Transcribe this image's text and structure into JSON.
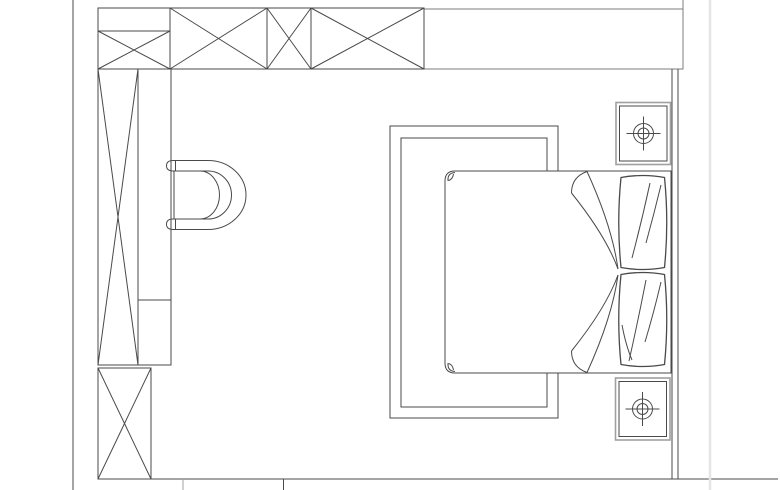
{
  "canvas": {
    "width": 780,
    "height": 490,
    "background": "#ffffff"
  },
  "palette": {
    "dark": "#4a4a4a",
    "mid": "#7d7d7d",
    "light": "#a0a0a0",
    "faint": "#e4e4e4",
    "fill": "#ffffff"
  },
  "floor_plan": {
    "group_order": [
      "walls",
      "wardrobe_top",
      "wardrobe_left",
      "armchair",
      "rug",
      "bed",
      "pillows",
      "nightstand_top",
      "nightstand_bottom"
    ],
    "groups": {
      "walls": [
        {
          "name": "left-wall-line",
          "type": "line",
          "x1": 73,
          "y1": 0,
          "x2": 73,
          "y2": 490
        },
        {
          "name": "top-wall-right-strip",
          "type": "rect",
          "x": 424,
          "y": 9,
          "w": 259,
          "h": 60,
          "stroke": "mid"
        },
        {
          "name": "top-wall-right-corner-line",
          "type": "line",
          "x1": 683,
          "y1": 0,
          "x2": 683,
          "y2": 9,
          "stroke": "mid"
        },
        {
          "name": "right-wall-inner-line",
          "type": "line",
          "x1": 672,
          "y1": 69,
          "x2": 672,
          "y2": 479
        },
        {
          "name": "right-wall-outer-line",
          "type": "line",
          "x1": 678,
          "y1": 69,
          "x2": 678,
          "y2": 479
        },
        {
          "name": "bottom-wall-line",
          "type": "line",
          "x1": 98,
          "y1": 479,
          "x2": 778,
          "y2": 479
        },
        {
          "name": "bottom-wall-tick-left",
          "type": "line",
          "x1": 183,
          "y1": 479,
          "x2": 183,
          "y2": 490,
          "stroke": "light"
        },
        {
          "name": "bottom-wall-tick-right",
          "type": "line",
          "x1": 283.5,
          "y1": 479,
          "x2": 283.5,
          "y2": 490
        },
        {
          "name": "page-edge-line",
          "type": "line",
          "x1": 710,
          "y1": 0,
          "x2": 710,
          "y2": 490,
          "stroke": "faint",
          "sw": 2.5
        }
      ],
      "wardrobe_top": [
        {
          "name": "wardrobe-top-cabinet-a",
          "type": "rect",
          "x": 98,
          "y": 8,
          "w": 72,
          "h": 61
        },
        {
          "name": "cabinet-a-shelf-line",
          "type": "line",
          "x1": 98,
          "y1": 31,
          "x2": 170,
          "y2": 31
        },
        {
          "name": "cabinet-a-cross-line-1",
          "type": "line",
          "x1": 98,
          "y1": 31,
          "x2": 170,
          "y2": 69
        },
        {
          "name": "cabinet-a-cross-line-2",
          "type": "line",
          "x1": 170,
          "y1": 31,
          "x2": 98,
          "y2": 69
        },
        {
          "name": "wardrobe-top-cabinet-b",
          "type": "rect",
          "x": 170,
          "y": 8,
          "w": 97,
          "h": 61
        },
        {
          "name": "cabinet-b-cross-line-1",
          "type": "line",
          "x1": 170,
          "y1": 8,
          "x2": 267,
          "y2": 69
        },
        {
          "name": "cabinet-b-cross-line-2",
          "type": "line",
          "x1": 267,
          "y1": 8,
          "x2": 170,
          "y2": 69
        },
        {
          "name": "wardrobe-top-cabinet-c",
          "type": "rect",
          "x": 267,
          "y": 8,
          "w": 44,
          "h": 61
        },
        {
          "name": "cabinet-c-cross-line-1",
          "type": "line",
          "x1": 267,
          "y1": 8,
          "x2": 311,
          "y2": 69
        },
        {
          "name": "cabinet-c-cross-line-2",
          "type": "line",
          "x1": 311,
          "y1": 8,
          "x2": 267,
          "y2": 69
        },
        {
          "name": "wardrobe-top-cabinet-d",
          "type": "rect",
          "x": 311,
          "y": 8,
          "w": 113,
          "h": 61
        },
        {
          "name": "cabinet-d-cross-line-1",
          "type": "line",
          "x1": 311,
          "y1": 8,
          "x2": 424,
          "y2": 69
        },
        {
          "name": "cabinet-d-cross-line-2",
          "type": "line",
          "x1": 424,
          "y1": 8,
          "x2": 311,
          "y2": 69
        }
      ],
      "wardrobe_left": [
        {
          "name": "wardrobe-left-tall-cabinet",
          "type": "rect",
          "x": 98,
          "y": 69,
          "w": 40,
          "h": 296
        },
        {
          "name": "tall-cabinet-cross-line-1",
          "type": "line",
          "x1": 98,
          "y1": 69,
          "x2": 138,
          "y2": 365
        },
        {
          "name": "tall-cabinet-cross-line-2",
          "type": "line",
          "x1": 138,
          "y1": 69,
          "x2": 98,
          "y2": 365
        },
        {
          "name": "wardrobe-left-side-column",
          "type": "rect",
          "x": 138,
          "y": 69,
          "w": 33,
          "h": 296
        },
        {
          "name": "side-column-shelf-line",
          "type": "line",
          "x1": 138,
          "y1": 300,
          "x2": 171,
          "y2": 300
        },
        {
          "name": "wardrobe-left-lower-cabinet",
          "type": "rect",
          "x": 98,
          "y": 368,
          "w": 53,
          "h": 111
        },
        {
          "name": "lower-cabinet-cross-line-1",
          "type": "line",
          "x1": 98,
          "y1": 368,
          "x2": 151,
          "y2": 479
        },
        {
          "name": "lower-cabinet-cross-line-2",
          "type": "line",
          "x1": 151,
          "y1": 368,
          "x2": 98,
          "y2": 479
        }
      ],
      "armchair": [
        {
          "name": "armchair-top-armrest",
          "type": "path",
          "d": "M 208 160.5 L 173 160.5 Q 166.5 160.5 166.5 165.8 Q 166.5 171 173 171 L 208 171"
        },
        {
          "name": "armchair-top-armrest-cap-line",
          "type": "line",
          "x1": 175.5,
          "y1": 160.5,
          "x2": 175.5,
          "y2": 171
        },
        {
          "name": "armchair-bottom-armrest",
          "type": "path",
          "d": "M 208 219 L 173 219 Q 166.5 219 166.5 224.3 Q 166.5 229.5 173 229.5 L 208 229.5"
        },
        {
          "name": "armchair-bottom-armrest-cap-line",
          "type": "line",
          "x1": 175.5,
          "y1": 219,
          "x2": 175.5,
          "y2": 229.5
        },
        {
          "name": "armchair-backrest-outer-arc",
          "type": "path",
          "d": "M 208 160.5 A 38 34.5 0 0 1 208 229.5"
        },
        {
          "name": "armchair-backrest-inner-arc",
          "type": "path",
          "d": "M 208 171 A 23.5 24 0 0 1 208 219"
        },
        {
          "name": "armchair-seatback-arc",
          "type": "path",
          "d": "M 200 171 A 19.5 24 0 0 1 200 219"
        },
        {
          "name": "armchair-seat-front-line",
          "type": "line",
          "x1": 174,
          "y1": 171,
          "x2": 174,
          "y2": 219
        }
      ],
      "rug": [
        {
          "name": "rug-outer-border",
          "type": "rect",
          "x": 390,
          "y": 126,
          "w": 168,
          "h": 292
        },
        {
          "name": "rug-inner-border",
          "type": "rect",
          "x": 401,
          "y": 138,
          "w": 146,
          "h": 269
        }
      ],
      "bed": [
        {
          "name": "bed-outline",
          "type": "path",
          "d": "M 671 171 L 455 171 Q 445 171 445 181 L 445 363 Q 445 373 455 373 L 671 373 Z",
          "fill": "white"
        },
        {
          "name": "bed-corner-curl-top",
          "type": "path",
          "d": "M 455 172.5 Q 447.5 173 448 180.5 Q 452.5 180 453.5 174"
        },
        {
          "name": "bed-corner-curl-bottom",
          "type": "path",
          "d": "M 455 371.5 Q 447.5 371 448 363.5 Q 452.5 364 453.5 370"
        },
        {
          "name": "duvet-fold-top-curl",
          "type": "path",
          "d": "M 587 171.5 Q 571.5 177 571.5 193"
        },
        {
          "name": "duvet-fold-top-sweep-1",
          "type": "path",
          "d": "M 571.5 193 Q 606 236 618 269"
        },
        {
          "name": "duvet-fold-top-sweep-2",
          "type": "path",
          "d": "M 587 171.5 Q 612 226 618 269"
        },
        {
          "name": "duvet-fold-bottom-curl",
          "type": "path",
          "d": "M 587 372.5 Q 571.5 367 571.5 351"
        },
        {
          "name": "duvet-fold-bottom-sweep-1",
          "type": "path",
          "d": "M 571.5 351 Q 606 308 618 275"
        },
        {
          "name": "duvet-fold-bottom-sweep-2",
          "type": "path",
          "d": "M 587 372.5 Q 612 318 618 275"
        }
      ],
      "pillows": [
        {
          "name": "pillow-top",
          "type": "path",
          "d": "M 621 177.5 Q 643 173.5 664.5 177.5 Q 669 222.5 664.5 267.5 Q 643 271.5 621 267.5 Q 616.5 222.5 621 177.5 Z",
          "fill": "white",
          "sw": 1.3
        },
        {
          "name": "pillow-top-fold-line-1",
          "type": "path",
          "d": "M 650 183 Q 642 220 632 258"
        },
        {
          "name": "pillow-top-fold-line-2",
          "type": "path",
          "d": "M 661 185 Q 654 214 646 243"
        },
        {
          "name": "pillow-bottom",
          "type": "path",
          "d": "M 621 274.5 Q 643 270.5 664.5 274.5 Q 669 319.5 664.5 364.5 Q 643 368.5 621 364.5 Q 616.5 319.5 621 274.5 Z",
          "fill": "white",
          "sw": 1.3
        },
        {
          "name": "pillow-bottom-fold-line-1",
          "type": "path",
          "d": "M 646 280 Q 638 321 629 361"
        },
        {
          "name": "pillow-bottom-fold-line-2",
          "type": "path",
          "d": "M 661 282 Q 654 312 645 342"
        },
        {
          "name": "pillow-bottom-fold-line-3",
          "type": "path",
          "d": "M 622 325 Q 626 346 632 360"
        }
      ],
      "nightstand_top": [
        {
          "name": "nightstand-top-outer",
          "type": "rect",
          "x": 616,
          "y": 102.5,
          "w": 54.5,
          "h": 62,
          "stroke": "light",
          "sw": 1.6,
          "fill": "white"
        },
        {
          "name": "nightstand-top-inner",
          "type": "rect",
          "x": 619.5,
          "y": 106,
          "w": 47.5,
          "h": 55
        },
        {
          "name": "lamp-top-outer-circle",
          "type": "circle",
          "cx": 643.5,
          "cy": 133.5,
          "r": 10
        },
        {
          "name": "lamp-top-inner-circle",
          "type": "circle",
          "cx": 643.5,
          "cy": 133.5,
          "r": 5.5
        },
        {
          "name": "lamp-top-crosshair-h",
          "type": "line",
          "x1": 626.5,
          "y1": 133.5,
          "x2": 660.5,
          "y2": 133.5
        },
        {
          "name": "lamp-top-crosshair-v",
          "type": "line",
          "x1": 643.5,
          "y1": 116.5,
          "x2": 643.5,
          "y2": 150.5
        }
      ],
      "nightstand_bottom": [
        {
          "name": "nightstand-bottom-outer",
          "type": "rect",
          "x": 615.5,
          "y": 378,
          "w": 54.5,
          "h": 62,
          "stroke": "light",
          "sw": 1.6,
          "fill": "white"
        },
        {
          "name": "nightstand-bottom-inner",
          "type": "rect",
          "x": 619,
          "y": 381.5,
          "w": 47.5,
          "h": 55
        },
        {
          "name": "lamp-bottom-outer-circle",
          "type": "circle",
          "cx": 642.5,
          "cy": 409,
          "r": 10
        },
        {
          "name": "lamp-bottom-inner-circle",
          "type": "circle",
          "cx": 642.5,
          "cy": 409,
          "r": 5.5
        },
        {
          "name": "lamp-bottom-crosshair-h",
          "type": "line",
          "x1": 625.5,
          "y1": 409,
          "x2": 659.5,
          "y2": 409
        },
        {
          "name": "lamp-bottom-crosshair-v",
          "type": "line",
          "x1": 642.5,
          "y1": 392,
          "x2": 642.5,
          "y2": 426
        }
      ]
    }
  }
}
